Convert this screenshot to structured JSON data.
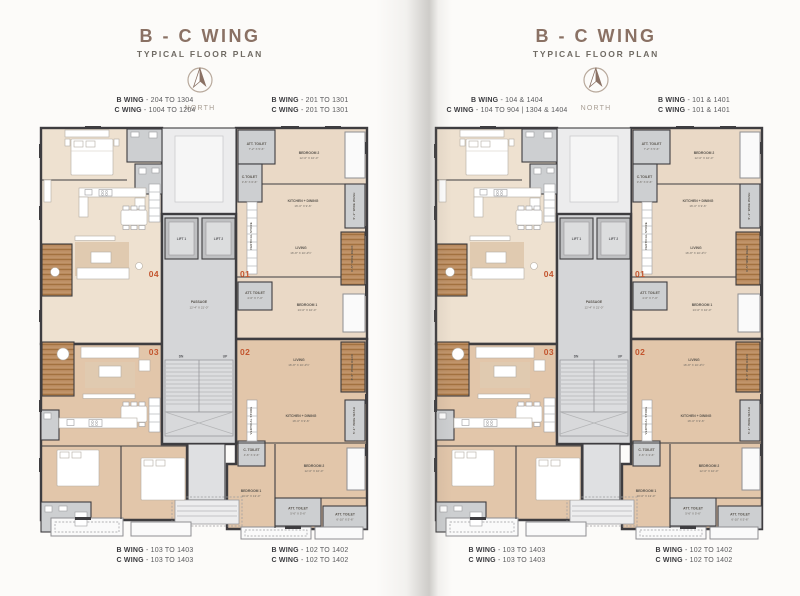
{
  "header": {
    "title": "B - C WING",
    "subtitle": "TYPICAL FLOOR PLAN",
    "north": "NORTH"
  },
  "pages": {
    "left": {
      "corners": {
        "top_left": [
          {
            "wing": "B WING",
            "range": "- 204 TO 1304"
          },
          {
            "wing": "C WING",
            "range": "- 1004 TO 1204"
          }
        ],
        "top_right": [
          {
            "wing": "B WING",
            "range": "- 201 TO 1301"
          },
          {
            "wing": "C WING",
            "range": "- 201 TO 1301"
          }
        ],
        "bottom_left": [
          {
            "wing": "B WING",
            "range": "- 103 TO 1403"
          },
          {
            "wing": "C WING",
            "range": "- 103 TO 1403"
          }
        ],
        "bottom_right": [
          {
            "wing": "B WING",
            "range": "- 102 TO 1402"
          },
          {
            "wing": "C WING",
            "range": "- 102 TO 1402"
          }
        ]
      }
    },
    "right": {
      "corners": {
        "top_left": [
          {
            "wing": "B WING",
            "range": "- 104 & 1404"
          },
          {
            "wing": "C WING",
            "range": "- 104 TO 904  |  1304 & 1404"
          }
        ],
        "top_right": [
          {
            "wing": "B WING",
            "range": "- 101 & 1401"
          },
          {
            "wing": "C WING",
            "range": "- 101 & 1401"
          }
        ],
        "bottom_left": [
          {
            "wing": "B WING",
            "range": "- 103 TO 1403"
          },
          {
            "wing": "C WING",
            "range": "- 103 TO 1403"
          }
        ],
        "bottom_right": [
          {
            "wing": "B WING",
            "range": "- 102 TO 1402"
          },
          {
            "wing": "C WING",
            "range": "- 102 TO 1402"
          }
        ]
      }
    }
  },
  "plan": {
    "lift1": "LIFT 1",
    "lift2": "LIFT 2",
    "passage": {
      "name": "PASSAGE",
      "dim": "12'-4\" X 21'-0\""
    },
    "dn": "DN",
    "up": "UP",
    "unit_numbers": {
      "u1": "01",
      "u2": "02",
      "u3": "03",
      "u4": "04"
    },
    "unit01": {
      "att_toilet": {
        "name": "ATT. TOILET",
        "dim": "7'-2\" X 5'-6\""
      },
      "bedroom2": {
        "name": "BEDROOM 2",
        "dim": "12'-0\" X 10'-0\""
      },
      "c_toilet": {
        "name": "C.TOILET",
        "dim": "3'-6\" X 6'-6\""
      },
      "vertical_store": "VERTICAL STORE",
      "kitchen": {
        "name": "KITCHEN + DINING",
        "dim": "16'-0\" X 9'-6\""
      },
      "wash": "5'-1\" WIDE WASH",
      "living": {
        "name": "LIVING",
        "dim": "16'-8\" X 10'-4½\""
      },
      "deck": "6'-5\" WIDE DECK",
      "att_toilet2": {
        "name": "ATT. TOILET",
        "dim": "4'-6\" X 7'-0\""
      },
      "bedroom1": {
        "name": "BEDROOM 1",
        "dim": "13'-0\" X 10'-0\""
      }
    },
    "unit02": {
      "living": {
        "name": "LIVING",
        "dim": "16'-8\" X 10'-4½\""
      },
      "deck": "6'-5\" WIDE DECK",
      "kitchen": {
        "name": "KITCHEN + DINING",
        "dim": "16'-0\" X 9'-6\""
      },
      "wash": "5'-1\" WIDE WASH",
      "vertical_store": "VERTICAL STORE",
      "c_toilet": {
        "name": "C. TOILET",
        "dim": "4'-6\" X 3'-6\""
      },
      "bedroom2": {
        "name": "BEDROOM 2",
        "dim": "12'-0\" X 10'-0\""
      },
      "bedroom1": {
        "name": "BEDROOM 1",
        "dim": "10'-0\" X 13'-0\""
      },
      "att_toilet1": {
        "name": "ATT. TOILET",
        "dim": "5'-6\" X 5'-6\""
      },
      "att_toilet2": {
        "name": "ATT. TOILET",
        "dim": "6'-10\" X 5'-6\""
      }
    }
  },
  "colors": {
    "accent_unit_number": "#c3552e",
    "title": "#8a7164",
    "wall": "#3e3d40",
    "wood": "#b98a5e"
  }
}
